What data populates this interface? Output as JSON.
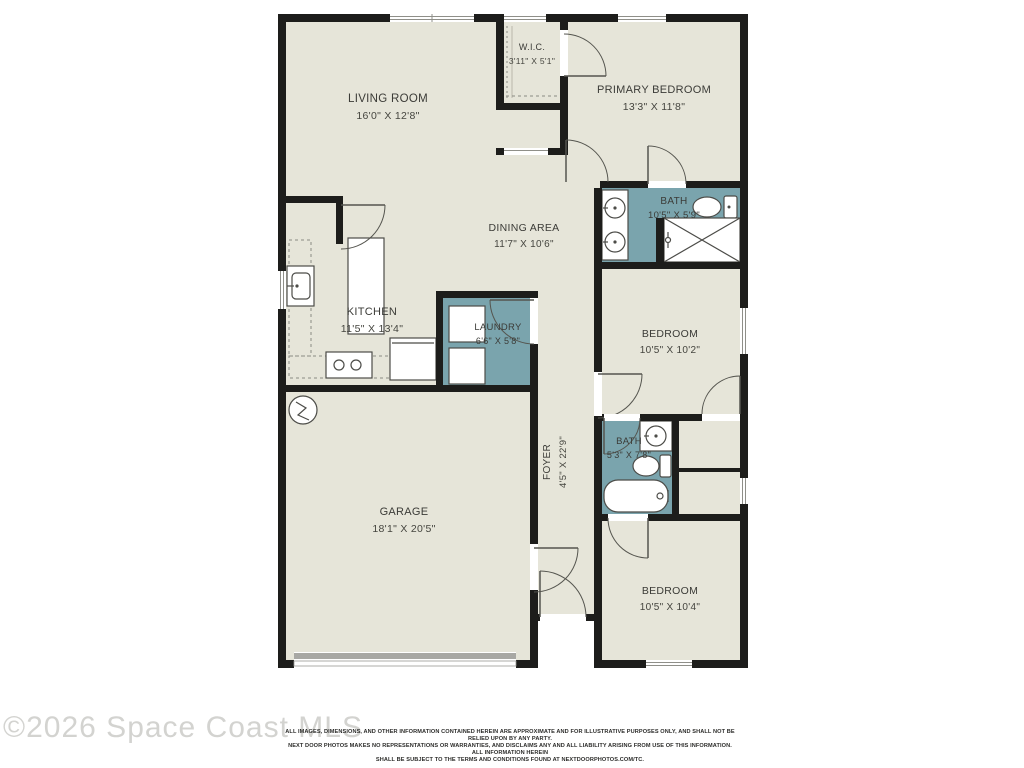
{
  "watermark": "©2026 Space Coast MLS",
  "disclaimer": {
    "line1": "ALL IMAGES, DIMENSIONS, AND OTHER INFORMATION CONTAINED HEREIN ARE APPROXIMATE AND FOR ILLUSTRATIVE PURPOSES ONLY, AND SHALL NOT BE RELIED UPON BY ANY PARTY.",
    "line2": "NEXT DOOR PHOTOS MAKES NO REPRESENTATIONS OR WARRANTIES, AND DISCLAIMS ANY AND ALL LIABILITY ARISING FROM USE OF THIS INFORMATION. ALL INFORMATION HEREIN",
    "line3": "SHALL BE SUBJECT TO THE TERMS AND CONDITIONS FOUND AT NEXTDOORPHOTOS.COM/TC."
  },
  "colors": {
    "wall": "#1d1d1b",
    "room_fill": "#e6e5d9",
    "wet_room_fill": "#7aa4ad",
    "garage_door": "#a8a8a4",
    "label_text": "#3b3b37"
  },
  "rooms": {
    "living_room": {
      "name": "LIVING ROOM",
      "dims": "16'0\" X 12'8\""
    },
    "wic": {
      "name": "W.I.C.",
      "dims": "3'11\" X 5'1\""
    },
    "primary_bedroom": {
      "name": "PRIMARY BEDROOM",
      "dims": "13'3\" X 11'8\""
    },
    "bath1": {
      "name": "BATH",
      "dims": "10'5\" X 5'9\""
    },
    "dining": {
      "name": "DINING AREA",
      "dims": "11'7\" X 10'6\""
    },
    "kitchen": {
      "name": "KITCHEN",
      "dims": "11'5\" X 13'4\""
    },
    "laundry": {
      "name": "LAUNDRY",
      "dims": "6'6\" X 5'8\""
    },
    "bedroom2": {
      "name": "BEDROOM",
      "dims": "10'5\" X 10'2\""
    },
    "bath2": {
      "name": "BATH",
      "dims": "5'3\" X 7'8\""
    },
    "foyer": {
      "name": "FOYER",
      "dims": "4'5\" X 22'9\""
    },
    "garage": {
      "name": "GARAGE",
      "dims": "18'1\" X 20'5\""
    },
    "bedroom3": {
      "name": "BEDROOM",
      "dims": "10'5\" X 10'4\""
    }
  }
}
